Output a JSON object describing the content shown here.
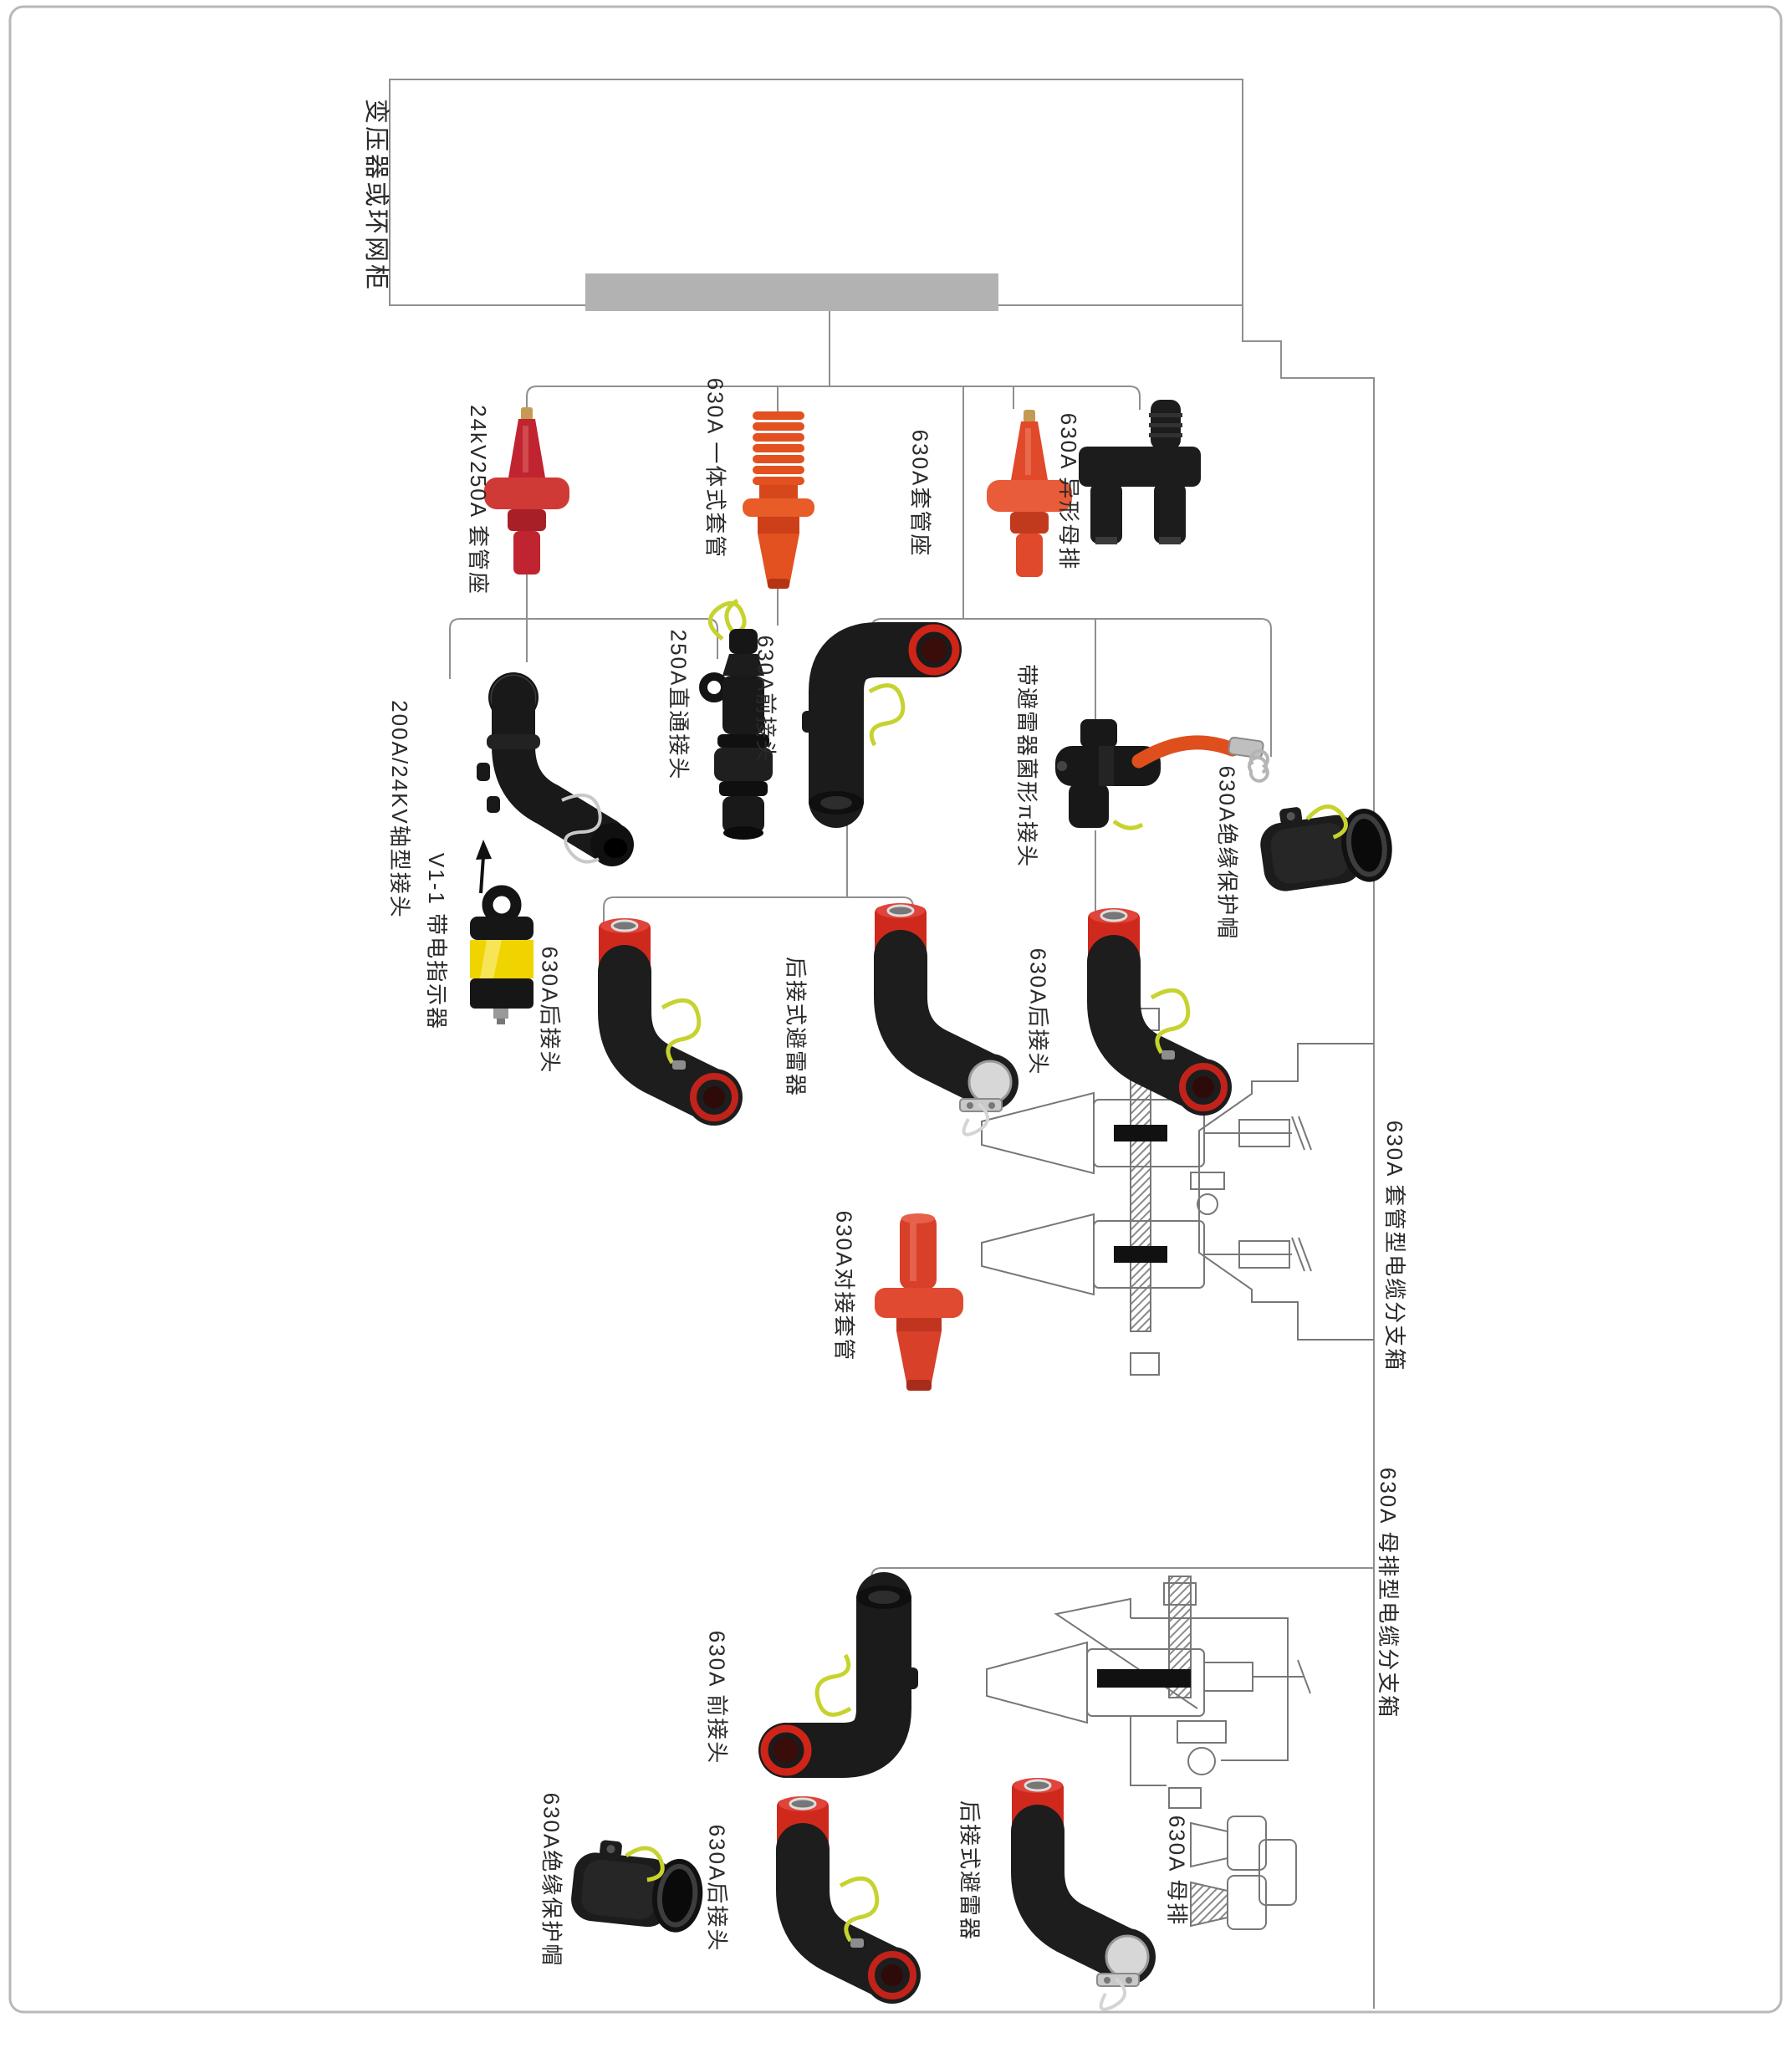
{
  "page": {
    "type": "product-application-diagram",
    "background": "#ffffff",
    "border_color": "#b8b8b8",
    "line_color": "#8f8f8f",
    "gray_bar_color": "#b2b2b2"
  },
  "palette": {
    "bushing_red": "#bf2430",
    "bushing_orange": "#e2511f",
    "cap_red": "#cf291d",
    "product_black": "#1b1b1b",
    "ground_wire_yellow": "#c6d32f",
    "indicator_yellow": "#f0d400",
    "drawing_line": "#777777",
    "text": "#2a2a2a"
  },
  "labels": {
    "cabinet": "变压器或环网柜",
    "bushing_24kv250a": "24kV250A 套管座",
    "bushing_630a_integrated": "630A 一体式套管",
    "bushing_630a_seat": "630A套管座",
    "busbar_shaped": "630A 异形母排",
    "connector_axial": "200A/24KV轴型接头",
    "connector_straight_250a": "250A直通接头",
    "connector_front_mid": "630A前接头",
    "connector_pi_arrester": "带避雷器菌形π接头",
    "cap_insulation_mid": "630A绝缘保护帽",
    "live_indicator": "V1-1 带电指示器",
    "connector_rear_mid_left": "630A后接头",
    "arrester_rear_mid": "后接式避雷器",
    "connector_rear_mid_right": "630A后接头",
    "bushing_butt": "630A对接套管",
    "box_bushing_type": "630A 套管型电缆分支箱",
    "box_busbar_type": "630A 母排型电缆分支箱",
    "connector_front_bottom": "630A 前接头",
    "cap_insulation_bottom": "630A绝缘保护帽",
    "connector_rear_bottom": "630A后接头",
    "arrester_rear_bottom": "后接式避雷器",
    "busbar_630a": "630A 母排"
  }
}
